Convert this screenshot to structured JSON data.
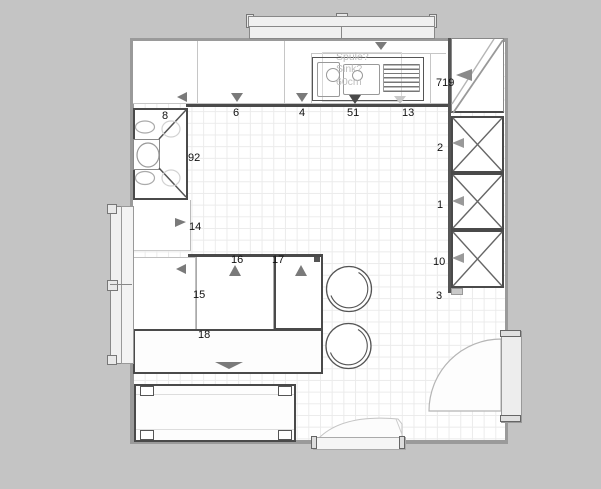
{
  "colors": {
    "background": "#c4c4c4",
    "floor": "#ffffff",
    "grid": "#ebebeb",
    "wall": "#9a9a9a",
    "dark": "#4a4a4a",
    "line": "#aaaaaa",
    "arrow": "#7a7a7a",
    "ghost": "#bdbdbd",
    "label": "#111111"
  },
  "plan": {
    "item_labels": [
      {
        "text": "6"
      },
      {
        "text": "4"
      },
      {
        "text": "51"
      },
      {
        "text": "13"
      },
      {
        "text": "719"
      },
      {
        "text": "8"
      },
      {
        "text": "92"
      },
      {
        "text": "14"
      },
      {
        "text": "2"
      },
      {
        "text": "1"
      },
      {
        "text": "10"
      },
      {
        "text": "3"
      },
      {
        "text": "16"
      },
      {
        "text": "17"
      },
      {
        "text": "15"
      },
      {
        "text": "18"
      }
    ],
    "sink_note": {
      "line1": "Spüle?",
      "line2": "Sink?",
      "line3": "60cm"
    }
  }
}
